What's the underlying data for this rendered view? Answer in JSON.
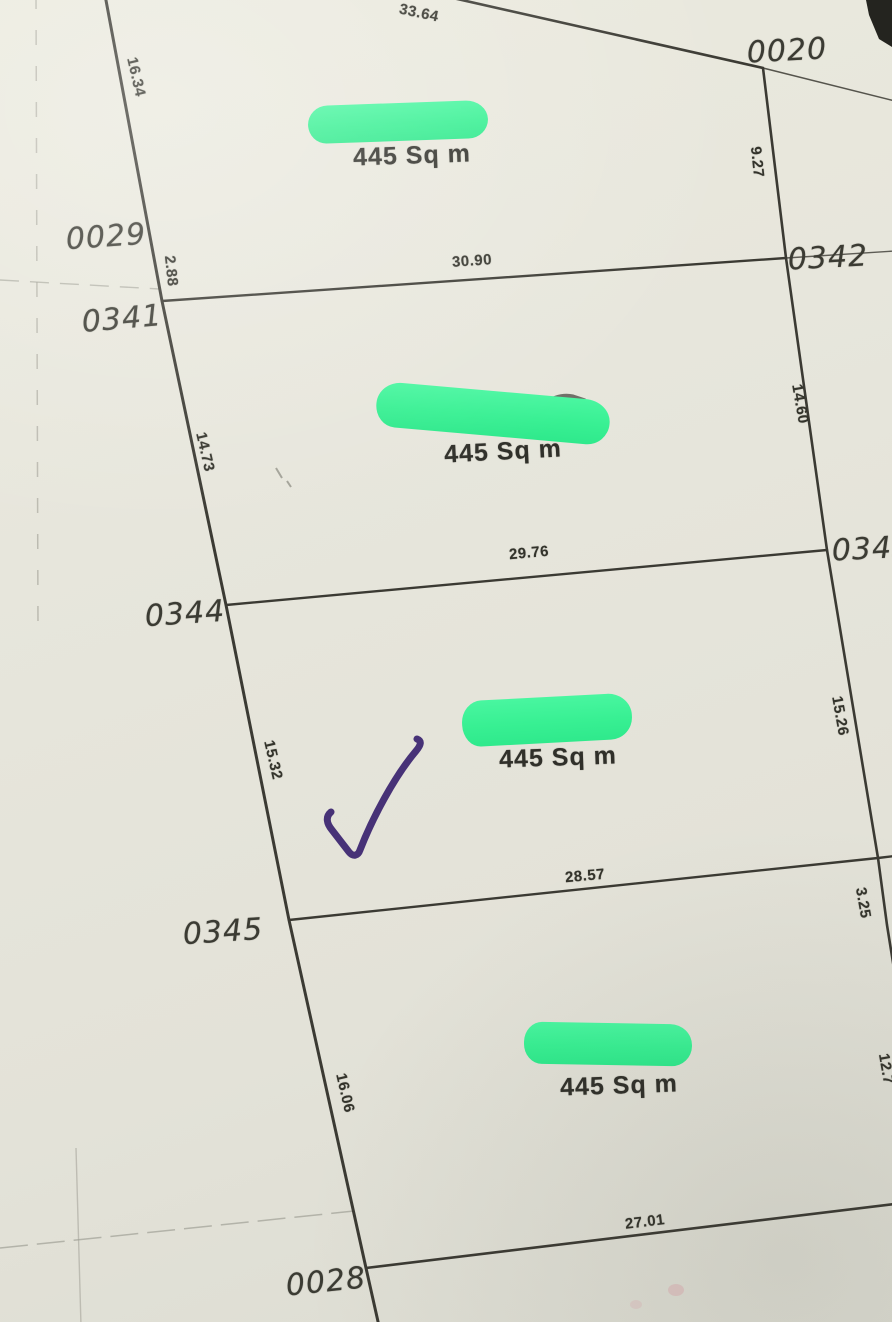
{
  "plan": {
    "parcel_labels": [
      {
        "id": "0020"
      },
      {
        "id": "0029"
      },
      {
        "id": "0341"
      },
      {
        "id": "0342"
      },
      {
        "id": "0344"
      },
      {
        "id": "0343"
      },
      {
        "id": "0345"
      },
      {
        "id": "0028"
      }
    ],
    "measurements": [
      {
        "value": "33.64"
      },
      {
        "value": "16.34"
      },
      {
        "value": "9.27"
      },
      {
        "value": "2.88"
      },
      {
        "value": "30.90"
      },
      {
        "value": "14.73"
      },
      {
        "value": "14.60"
      },
      {
        "value": "29.76"
      },
      {
        "value": "15.32"
      },
      {
        "value": "15.26"
      },
      {
        "value": "28.57"
      },
      {
        "value": "3.25"
      },
      {
        "value": "16.06"
      },
      {
        "value": "12.7"
      },
      {
        "value": "27.01"
      }
    ],
    "area_labels": [
      {
        "text": "445 Sq m"
      },
      {
        "text": "445 Sq m"
      },
      {
        "text": "445 Sq m"
      },
      {
        "text": "445 Sq m"
      }
    ]
  },
  "annotations": {
    "redaction_count": 4,
    "redaction_color": "#38f093",
    "checkmark_color": "#473277"
  },
  "colors": {
    "paper": "#e6e5dc",
    "boundary_line": "#3b3a33",
    "faint_line": "#a09f95",
    "label_text": "#35352f"
  }
}
